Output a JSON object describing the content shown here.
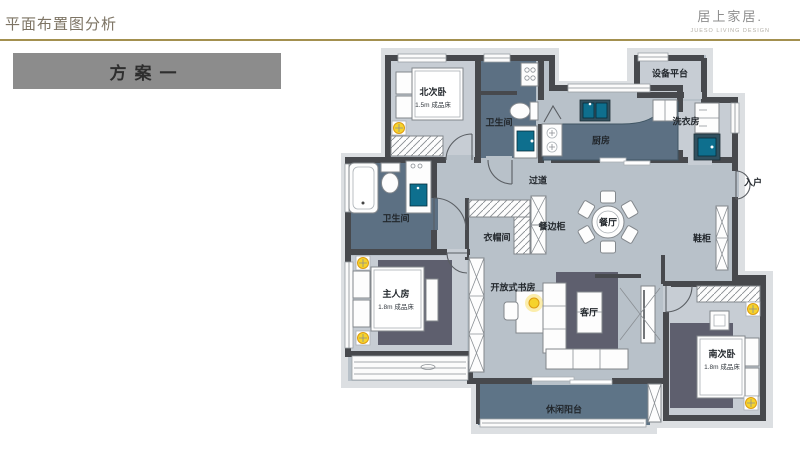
{
  "header": {
    "title": "平面布置图分析",
    "brand_name": "居上家居.",
    "brand_tagline": "JUESO LIVING DESIGN"
  },
  "plan_badge": {
    "label": "方案一"
  },
  "floor_plan": {
    "rooms": [
      {
        "id": "north-bedroom",
        "label": "北次卧",
        "sub": "1.5m 成品床"
      },
      {
        "id": "bath-north",
        "label": "卫生间"
      },
      {
        "id": "equipment-platform",
        "label": "设备平台"
      },
      {
        "id": "laundry",
        "label": "洗衣房"
      },
      {
        "id": "kitchen",
        "label": "厨房"
      },
      {
        "id": "corridor",
        "label": "过道"
      },
      {
        "id": "entry",
        "label": "入户"
      },
      {
        "id": "shoe-cabinet",
        "label": "鞋柜"
      },
      {
        "id": "dining",
        "label": "餐厅"
      },
      {
        "id": "sideboard",
        "label": "餐边柜"
      },
      {
        "id": "cloakroom",
        "label": "衣帽间"
      },
      {
        "id": "bath-master",
        "label": "卫生间"
      },
      {
        "id": "master-bedroom",
        "label": "主人房",
        "sub": "1.8m 成品床"
      },
      {
        "id": "study",
        "label": "开放式书房"
      },
      {
        "id": "living",
        "label": "客厅"
      },
      {
        "id": "south-bedroom",
        "label": "南次卧",
        "sub": "1.8m 成品床"
      },
      {
        "id": "balcony",
        "label": "休闲阳台"
      }
    ]
  },
  "colors": {
    "title": "#7d7464",
    "gold": "#a3904f",
    "badge-bg": "#8c8c8c",
    "wall": "#47494d",
    "floor_common": "#b8c1c9",
    "floor_room": "#c7cdd4",
    "floor_wet": "#5c7083",
    "floor_balcony": "#5e7487",
    "rug": "#5e5f6e",
    "lamp": "#f6d32b",
    "sink": "#0e6f8e"
  }
}
